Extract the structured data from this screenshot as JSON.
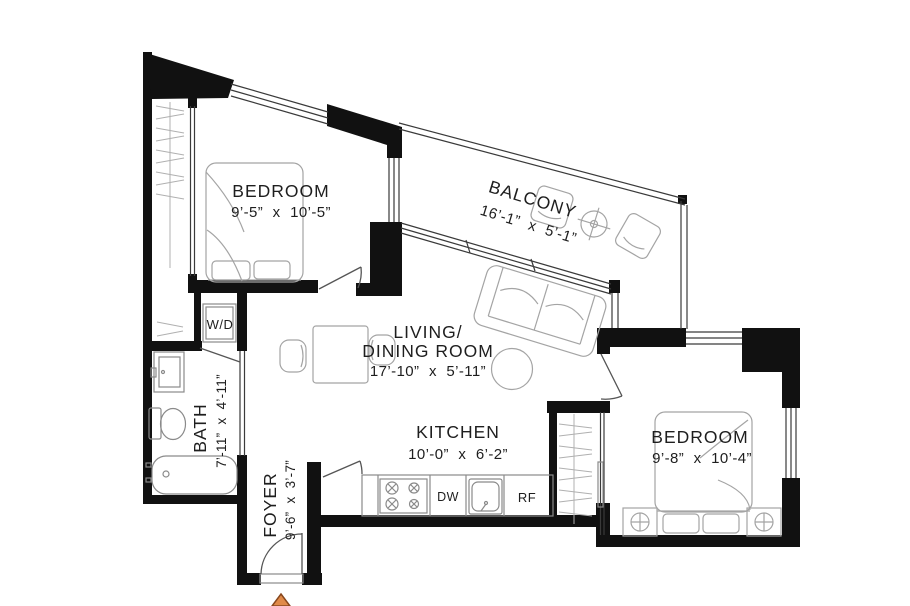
{
  "floor_plan": {
    "rooms": {
      "bedroom1": {
        "name": "BEDROOM",
        "dimensions": "9’-5” x 10’-5”"
      },
      "balcony": {
        "name": "BALCONY",
        "dimensions": "16’-1” x 5’-1”"
      },
      "living": {
        "name_line1": "LIVING/",
        "name_line2": "DINING ROOM",
        "dimensions": "17’-10” x 5’-11”"
      },
      "kitchen": {
        "name": "KITCHEN",
        "dimensions": "10’-0” x 6’-2”"
      },
      "bath": {
        "name": "BATH",
        "dimensions": "7’-11” x 4’-11”"
      },
      "foyer": {
        "name": "FOYER",
        "dimensions": "9’-6” x 3’-7”"
      },
      "bedroom2": {
        "name": "BEDROOM",
        "dimensions": "9’-8” x 10’-4”"
      }
    },
    "appliances": {
      "washer_dryer": "W/D",
      "dishwasher": "DW",
      "refrigerator": "RF"
    },
    "colors": {
      "wall": "#111111",
      "furniture_line": "#a4a4a4",
      "north_arrow_fill": "#e08a49",
      "north_arrow_stroke": "#87471d"
    }
  }
}
